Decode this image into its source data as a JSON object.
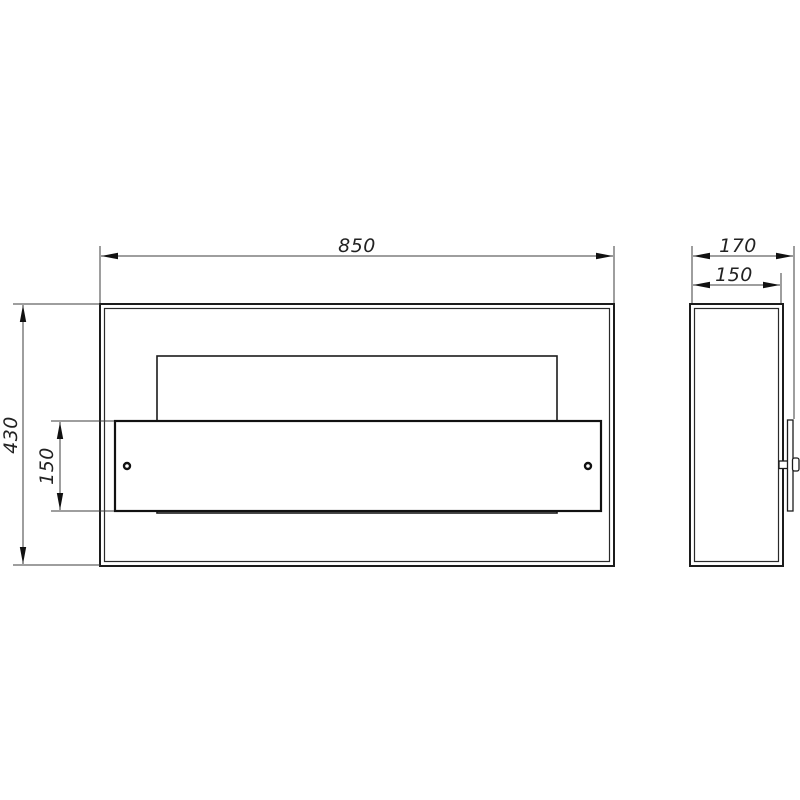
{
  "colors": {
    "background": "#ffffff",
    "object_line": "#1c1c1c",
    "thin_line": "#3d3d3d",
    "text": "#222222"
  },
  "dimensions": {
    "front_width": "850",
    "front_height": "430",
    "panel_height": "150",
    "side_overall_depth": "170",
    "side_body_depth": "150"
  }
}
